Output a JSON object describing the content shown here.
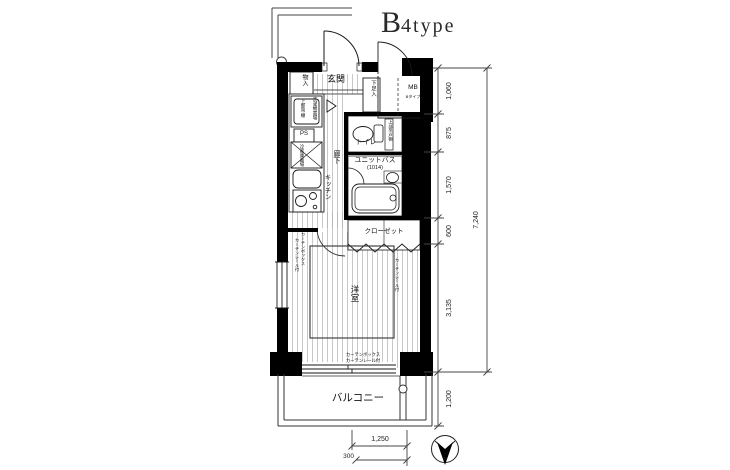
{
  "title": {
    "prefix": "B",
    "rest": "4type"
  },
  "rooms": {
    "entrance": "玄関",
    "storage": "物入",
    "shoe_box": "下足入",
    "meter_box": "MB",
    "meter_box_note": "Bタイプ",
    "toilet": "トイレ",
    "toilet_upper_cabinet": "上部吊戸棚",
    "unit_bath": "ユニットバス",
    "unit_bath_size": "(1014)",
    "hallway": "廊下",
    "kitchen": "キッチン",
    "washer_space": "洗濯機置場",
    "washer_upper_shelf": "上部吊棚",
    "pipe_space": "PS",
    "fridge_space": "冷蔵庫置場",
    "closet": "クローゼット",
    "western_room": "洋室",
    "balcony": "バルコニー",
    "curtain_box": "カーテンボックス",
    "curtain_rail": "カーテンレール付"
  },
  "dimensions": {
    "right_segments": [
      "1,060",
      "875",
      "1,570",
      "600",
      "3,135"
    ],
    "right_total": "7,240",
    "balcony_depth": "1,200",
    "bottom_width": "1,250",
    "bottom_offset": "300"
  },
  "compass": {
    "north": "N"
  },
  "colors": {
    "wall": "#000000",
    "line": "#1a1a1a",
    "stripe": "#b0b0b0",
    "dim": "#444444"
  }
}
